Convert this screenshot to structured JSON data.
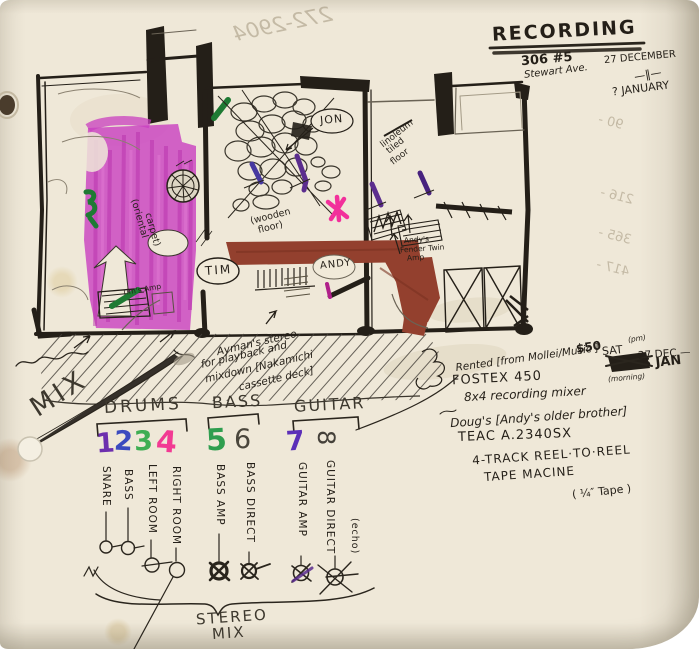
{
  "palette": {
    "paper": "#efe8d8",
    "ink": "#241f18",
    "pencil": "#4a453c",
    "carpet_magenta": "#c93fc0",
    "couch_brown": "#93402e",
    "green_marker": "#1e7a33",
    "purple_marker": "#5b2d8e",
    "blue_marker": "#4638a0",
    "pink_marker": "#f2309b",
    "channel_colors": [
      "#6d2fae",
      "#3b4bbf",
      "#3fae53",
      "#f23a93",
      "#2f9e4f",
      "#4a463c",
      "#5c2fb8",
      "#45413a"
    ]
  },
  "header": {
    "title": "RECORDING",
    "address1": "306 #5",
    "address2": "Stewart Ave.",
    "date_from": "27 DECEMBER",
    "date_thru": "—‖—",
    "date_to": "? JANUARY"
  },
  "bleed_through": {
    "phone": "272-2904",
    "numbers": [
      "90 -",
      "216 -",
      "365 -",
      "417 -"
    ]
  },
  "plan": {
    "people": {
      "jon": "JON",
      "tim": "TIM",
      "andy": "ANDY"
    },
    "carpet_l1": "(oriental",
    "carpet_l2": "carpet)",
    "wood_l1": "(wooden",
    "wood_l2": "floor)",
    "lino_l1": "linoleum",
    "lino_l2": "tiled",
    "lino_l3": "floor",
    "tims_amp": "Tim's Amp",
    "andys_amp_l1": "Andy's",
    "andys_amp_l2": "Fender Twin",
    "andys_amp_l3": "Amp"
  },
  "notes_left": {
    "mix": "MIX",
    "stereo_l1": "Ayman's stereo",
    "stereo_l2": "for playback and",
    "stereo_l3": "mixdown [Nakamichi",
    "stereo_l4": "cassette deck]"
  },
  "notes_right": {
    "price": "$50",
    "sat": "SAT",
    "pm": "(pm)",
    "dec": "27 DEC —",
    "rented": "Rented [from Mollei/Music ]",
    "jan5": "5 JAN",
    "morning": "(morning)",
    "fostex": "FOSTEX 450",
    "mixer": "8x4 recording mixer",
    "dougs": "Doug's [Andy's older brother]",
    "teac": "TEAC  A.2340SX",
    "track": "4-TRACK  REEL·TO·REEL",
    "machine": "TAPE MACINE",
    "tape": "( ¼″ Tape )"
  },
  "mixer": {
    "groups": [
      {
        "label": "DRUMS"
      },
      {
        "label": "BASS"
      },
      {
        "label": "GUITAR"
      }
    ],
    "channels": [
      {
        "n": "1",
        "label": "SNARE"
      },
      {
        "n": "2",
        "label": "BASS"
      },
      {
        "n": "3",
        "label": "LEFT ROOM"
      },
      {
        "n": "4",
        "label": "RIGHT ROOM"
      },
      {
        "n": "5",
        "label": "BASS AMP"
      },
      {
        "n": "6",
        "label": "BASS DIRECT"
      },
      {
        "n": "7",
        "label": "GUITAR AMP"
      },
      {
        "n": "8",
        "label": "GUITAR DIRECT",
        "sub": "(echo)"
      }
    ],
    "stereo_l1": "STEREO",
    "stereo_l2": "MIX"
  }
}
